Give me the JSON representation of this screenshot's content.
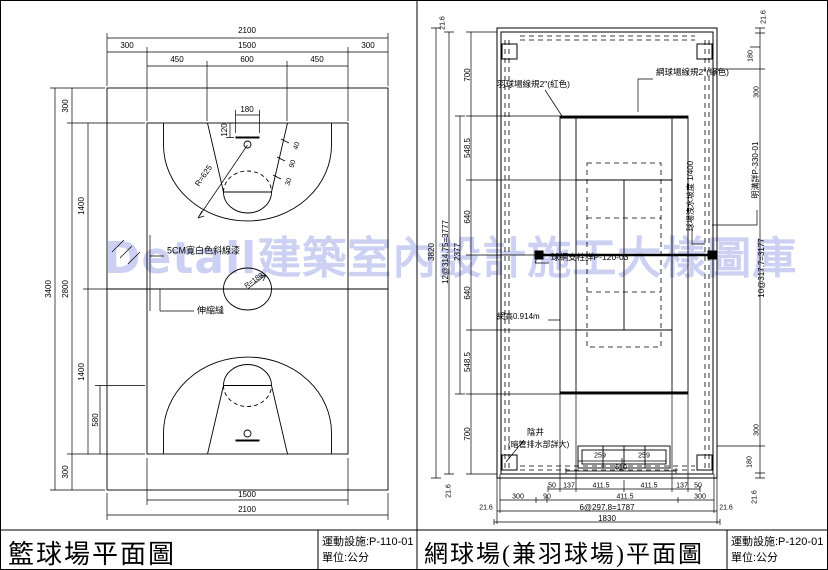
{
  "watermark": {
    "text": "Detail建築室內設計施工大樣圖庫",
    "color": "#ccd0f2"
  },
  "basketball": {
    "title": "籃球場平面圖",
    "sheet": "運動設施:P-110-01",
    "unit": "單位:公分",
    "dims": {
      "total_w": "2100",
      "margin_l": "300",
      "court_w": "1500",
      "margin_r": "300",
      "key_l": "450",
      "key_w": "600",
      "key_r": "450",
      "total_h": "3400",
      "margin_t": "300",
      "court_h": "2800",
      "margin_b": "300",
      "half_t": "1400",
      "half_b": "1400",
      "ft": "580",
      "backboard": "180",
      "bb_off": "120",
      "r3pt": "R=625",
      "rcenter": "R=180",
      "lane1": "40",
      "lane2": "90",
      "lane3": "30",
      "bot_court": "1500",
      "bot_total": "2100"
    },
    "labels": {
      "paint": "5CM寬白色斜線漆",
      "joint": "伸縮縫"
    }
  },
  "tennis": {
    "title": "網球場(兼羽球場)平面圖",
    "sheet": "運動設施:P-120-01",
    "unit": "單位:公分",
    "labels": {
      "badminton_line": "羽球場線規2\"(紅色)",
      "tennis_line": "網球場線規2\"(綠色)",
      "net_post": "球網支柱詳P-120-03",
      "net_height": "網高0.914m",
      "slope": "球場洩水坡度 1/400",
      "gutter": "明溝詳P-330-01",
      "pit": "陰井",
      "pit_note": "(暗管排水部詳大)"
    },
    "dims": {
      "edge": "21.6",
      "total_h": "3820",
      "run_l": "12@314.75=3777",
      "court_len": "2377",
      "back_t": "700",
      "base_t": "548.5",
      "srv_t": "640",
      "srv_b": "640",
      "base_b": "548.5",
      "back_b": "700",
      "gate": "180",
      "side_t": "300",
      "run_r": "10@317.7=3177",
      "side_b": "300",
      "gate_b": "180",
      "p50a": "50",
      "alley_a": "137",
      "half_a": "411.5",
      "half_b": "411.5",
      "alley_b": "137",
      "p50b": "50",
      "m300a": "300",
      "m90": "90",
      "mid": "411.5",
      "m300b": "300",
      "run_b": "6@297.8=1787",
      "total_w": "1830",
      "b259a": "259",
      "b259b": "259",
      "b610": "610"
    }
  }
}
